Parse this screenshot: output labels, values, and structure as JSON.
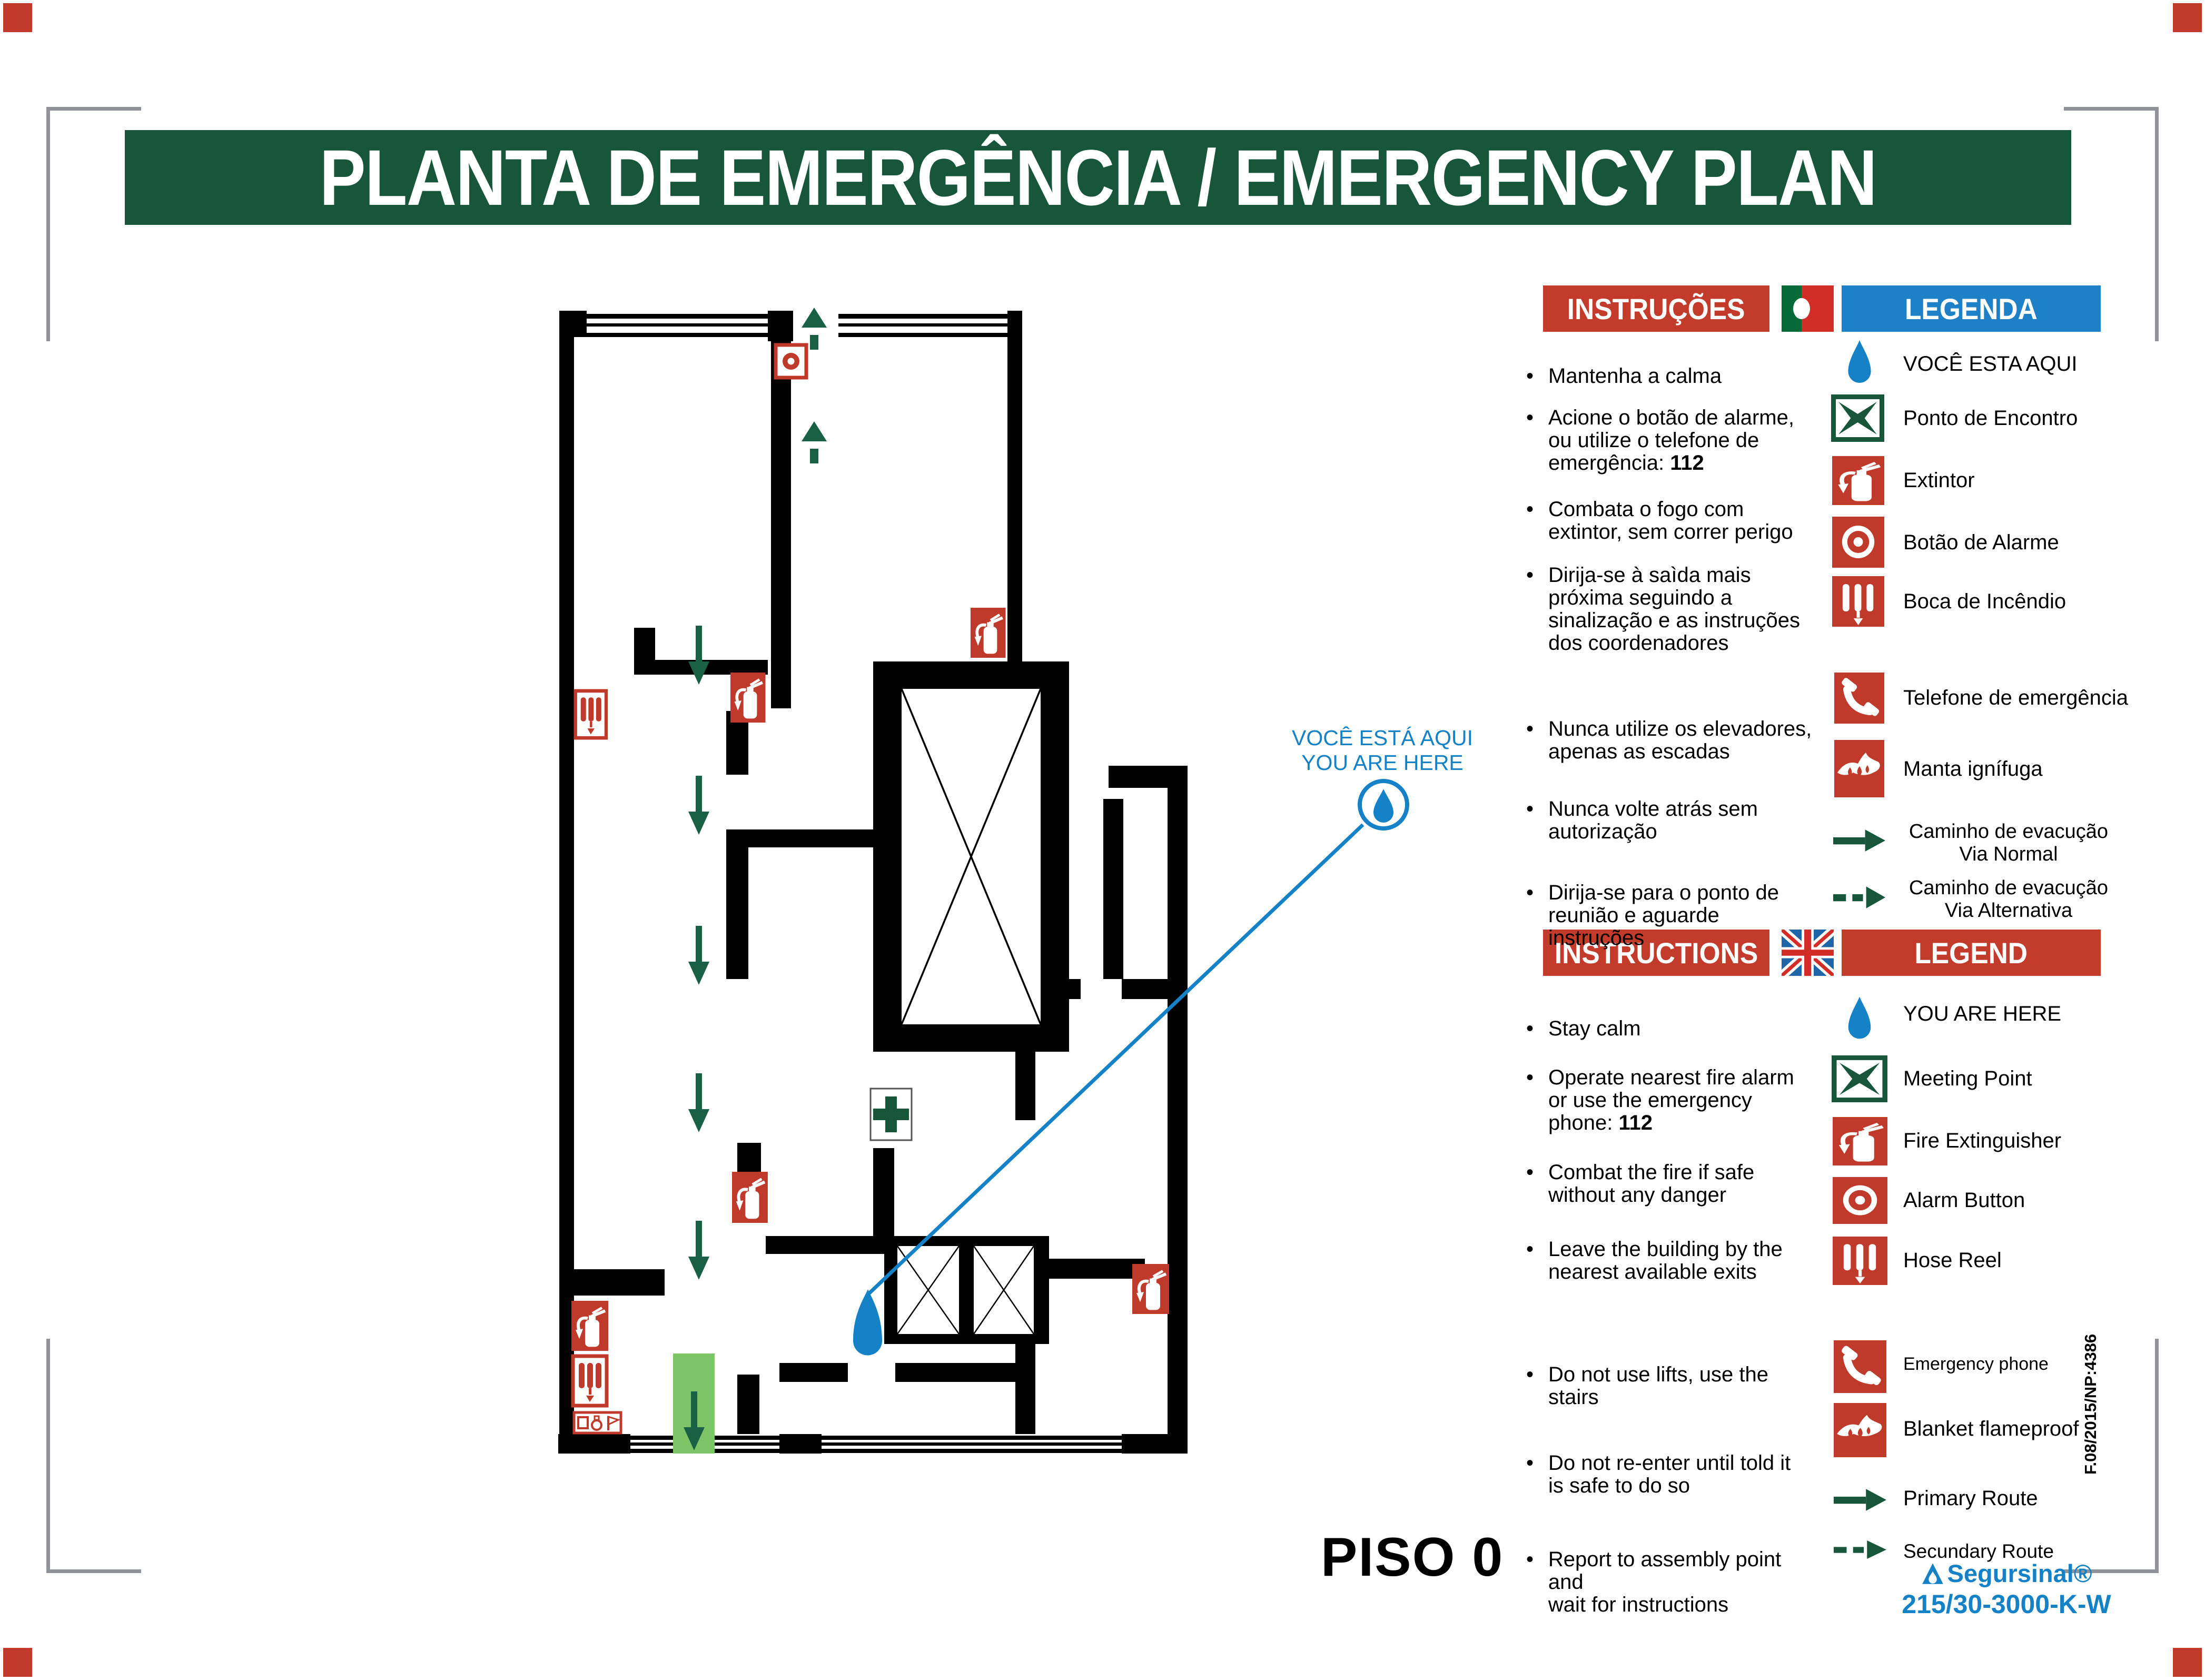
{
  "page": {
    "title": "PLANTA DE EMERGÊNCIA / EMERGENCY PLAN",
    "floor_label": "PISO 0"
  },
  "annotation": {
    "line1": "VOCÊ ESTÁ AQUI",
    "line2": "YOU ARE HERE"
  },
  "sections": {
    "pt": {
      "instructions_header": "INSTRUÇÕES",
      "legend_header": "LEGENDA",
      "flag": "portugal-flag",
      "instructions": [
        {
          "lines": [
            "Mantenha a calma"
          ]
        },
        {
          "lines": [
            "Acione o botão de alarme,",
            "ou utilize o telefone de",
            "emergência: "
          ],
          "bold": "112"
        },
        {
          "lines": [
            "Combata o fogo com",
            "extintor, sem correr perigo"
          ]
        },
        {
          "lines": [
            "Dirija-se à saìda mais",
            "próxima seguindo a",
            "sinalização e as instruções",
            "dos coordenadores"
          ]
        },
        {
          "lines": [
            "Nunca utilize os elevadores,",
            "apenas as escadas"
          ]
        },
        {
          "lines": [
            "Nunca volte atrás sem",
            "autorização"
          ]
        },
        {
          "lines": [
            "Dirija-se para o ponto de",
            "reunião e aguarde instruções"
          ]
        }
      ],
      "legend": [
        {
          "icon": "you-are-here-drop",
          "lines": [
            "VOCÊ ESTA AQUI"
          ]
        },
        {
          "icon": "meeting-point",
          "lines": [
            "Ponto de Encontro"
          ]
        },
        {
          "icon": "fire-extinguisher",
          "lines": [
            "Extintor"
          ]
        },
        {
          "icon": "alarm-button",
          "lines": [
            "Botão de Alarme"
          ]
        },
        {
          "icon": "hose-reel",
          "lines": [
            "Boca de Incêndio"
          ]
        },
        {
          "icon": "emergency-phone",
          "lines": [
            "Telefone de emergência"
          ]
        },
        {
          "icon": "fire-blanket",
          "lines": [
            "Manta ignífuga"
          ]
        },
        {
          "icon": "route-primary",
          "lines": [
            "Caminho de evacução",
            "Via Normal"
          ]
        },
        {
          "icon": "route-secondary",
          "lines": [
            "Caminho de evacução",
            "Via Alternativa"
          ]
        }
      ]
    },
    "en": {
      "instructions_header": "INSTRUCTIONS",
      "legend_header": "LEGEND",
      "flag": "uk-flag",
      "instructions": [
        {
          "lines": [
            "Stay calm"
          ]
        },
        {
          "lines": [
            "Operate nearest fire alarm",
            "or use the emergency",
            "phone: "
          ],
          "bold": "112"
        },
        {
          "lines": [
            "Combat the fire if safe",
            "without any danger"
          ]
        },
        {
          "lines": [
            "Leave the building by the",
            "nearest available exits"
          ]
        },
        {
          "lines": [
            "Do not use lifts, use the",
            "stairs"
          ]
        },
        {
          "lines": [
            "Do not re-enter until told it",
            "is safe to do so"
          ]
        },
        {
          "lines": [
            "Report to assembly point and",
            "wait for instructions"
          ]
        }
      ],
      "legend": [
        {
          "icon": "you-are-here-drop",
          "lines": [
            "YOU ARE HERE"
          ]
        },
        {
          "icon": "meeting-point",
          "lines": [
            "Meeting Point"
          ]
        },
        {
          "icon": "fire-extinguisher",
          "lines": [
            "Fire Extinguisher"
          ]
        },
        {
          "icon": "alarm-button",
          "lines": [
            "Alarm Button"
          ]
        },
        {
          "icon": "hose-reel",
          "lines": [
            "Hose Reel"
          ]
        },
        {
          "icon": "emergency-phone",
          "lines": [
            "Emergency phone"
          ]
        },
        {
          "icon": "fire-blanket",
          "lines": [
            "Blanket flameproof"
          ]
        },
        {
          "icon": "route-primary",
          "lines": [
            "Primary Route"
          ]
        },
        {
          "icon": "route-secondary",
          "lines": [
            "Secundary Route"
          ]
        }
      ]
    }
  },
  "footer": {
    "doc_ref": "F.08/2015/NP:4386",
    "brand": "Segursinal®",
    "product_code": "215/30-3000-K-W"
  },
  "colors": {
    "title_green": "#17563a",
    "route_green": "#1a6045",
    "exit_band_green": "#7dc567",
    "icon_red": "#c03a2b",
    "header_red": "#c23b2b",
    "legend_header_blue": "#1e80c6",
    "annotation_blue": "#1581c6"
  }
}
